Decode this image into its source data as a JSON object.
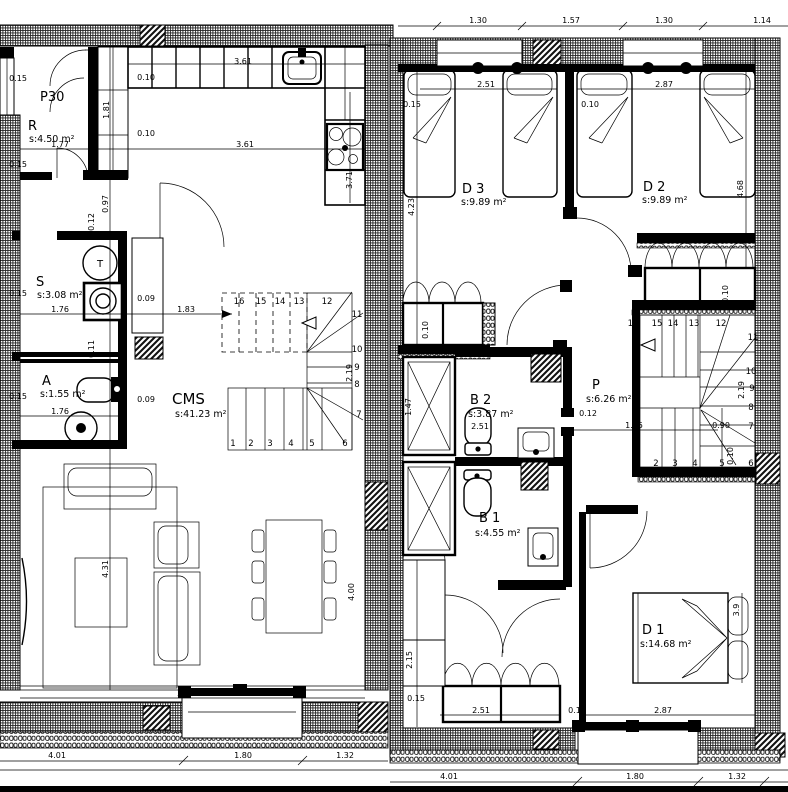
{
  "title": "Two-storey dwelling floor plans",
  "left": {
    "rooms": [
      {
        "label": "P30"
      },
      {
        "label": "R",
        "area": "s:4.50 m²"
      },
      {
        "label": "S",
        "area": "s:3.08 m²"
      },
      {
        "label": "A",
        "area": "s:1.55 m²"
      },
      {
        "label": "CMS",
        "area": "s:41.23 m²"
      }
    ],
    "fixture_labels": {
      "washer": "T"
    },
    "stairs": [
      "1",
      "2",
      "3",
      "4",
      "5",
      "6",
      "7",
      "8",
      "9",
      "10",
      "11",
      "12",
      "13",
      "14",
      "15",
      "16"
    ],
    "dims": [
      {
        "v": "0.15"
      },
      {
        "v": "0.10"
      },
      {
        "v": "3.61"
      },
      {
        "v": "1.81"
      },
      {
        "v": "0.10"
      },
      {
        "v": "1.77"
      },
      {
        "v": "3.61"
      },
      {
        "v": "3.71"
      },
      {
        "v": "0.97"
      },
      {
        "v": "0.12"
      },
      {
        "v": "0.15"
      },
      {
        "v": "0.15"
      },
      {
        "v": "1.76"
      },
      {
        "v": "0.09"
      },
      {
        "v": "1.83"
      },
      {
        "v": "0.11"
      },
      {
        "v": "0.15"
      },
      {
        "v": "0.09"
      },
      {
        "v": "1.76"
      },
      {
        "v": "2.19"
      },
      {
        "v": "4.31"
      },
      {
        "v": "4.00"
      },
      {
        "v": "5.48"
      },
      {
        "v": "4.01"
      },
      {
        "v": "1.80"
      },
      {
        "v": "1.32"
      }
    ]
  },
  "right": {
    "rooms": [
      {
        "label": "D 3",
        "area": "s:9.89 m²"
      },
      {
        "label": "D 2",
        "area": "s:9.89 m²"
      },
      {
        "label": "P",
        "area": "s:6.26 m²"
      },
      {
        "label": "B 2",
        "area": "s:3.87 m²"
      },
      {
        "label": "B 1",
        "area": "s:4.55 m²"
      },
      {
        "label": "D 1",
        "area": "s:14.68 m²"
      }
    ],
    "stairs": [
      "2",
      "3",
      "4",
      "5",
      "6",
      "7",
      "8",
      "9",
      "10",
      "11",
      "12",
      "13",
      "14",
      "15",
      "16"
    ],
    "dims": [
      {
        "v": "1.30"
      },
      {
        "v": "1.57"
      },
      {
        "v": "1.30"
      },
      {
        "v": "1.14"
      },
      {
        "v": "2.51"
      },
      {
        "v": "2.87"
      },
      {
        "v": "0.15"
      },
      {
        "v": "0.10"
      },
      {
        "v": "4.23"
      },
      {
        "v": "4.68"
      },
      {
        "v": "0.10"
      },
      {
        "v": "0.10"
      },
      {
        "v": "1.47"
      },
      {
        "v": "2.51"
      },
      {
        "v": "0.12"
      },
      {
        "v": "1.95"
      },
      {
        "v": "0.90"
      },
      {
        "v": "2.19"
      },
      {
        "v": "0.10"
      },
      {
        "v": "2.15"
      },
      {
        "v": "0.15"
      },
      {
        "v": "2.51"
      },
      {
        "v": "2.87"
      },
      {
        "v": "0.10"
      },
      {
        "v": "3.9"
      },
      {
        "v": "4.01"
      },
      {
        "v": "1.80"
      },
      {
        "v": "1.32"
      }
    ]
  }
}
